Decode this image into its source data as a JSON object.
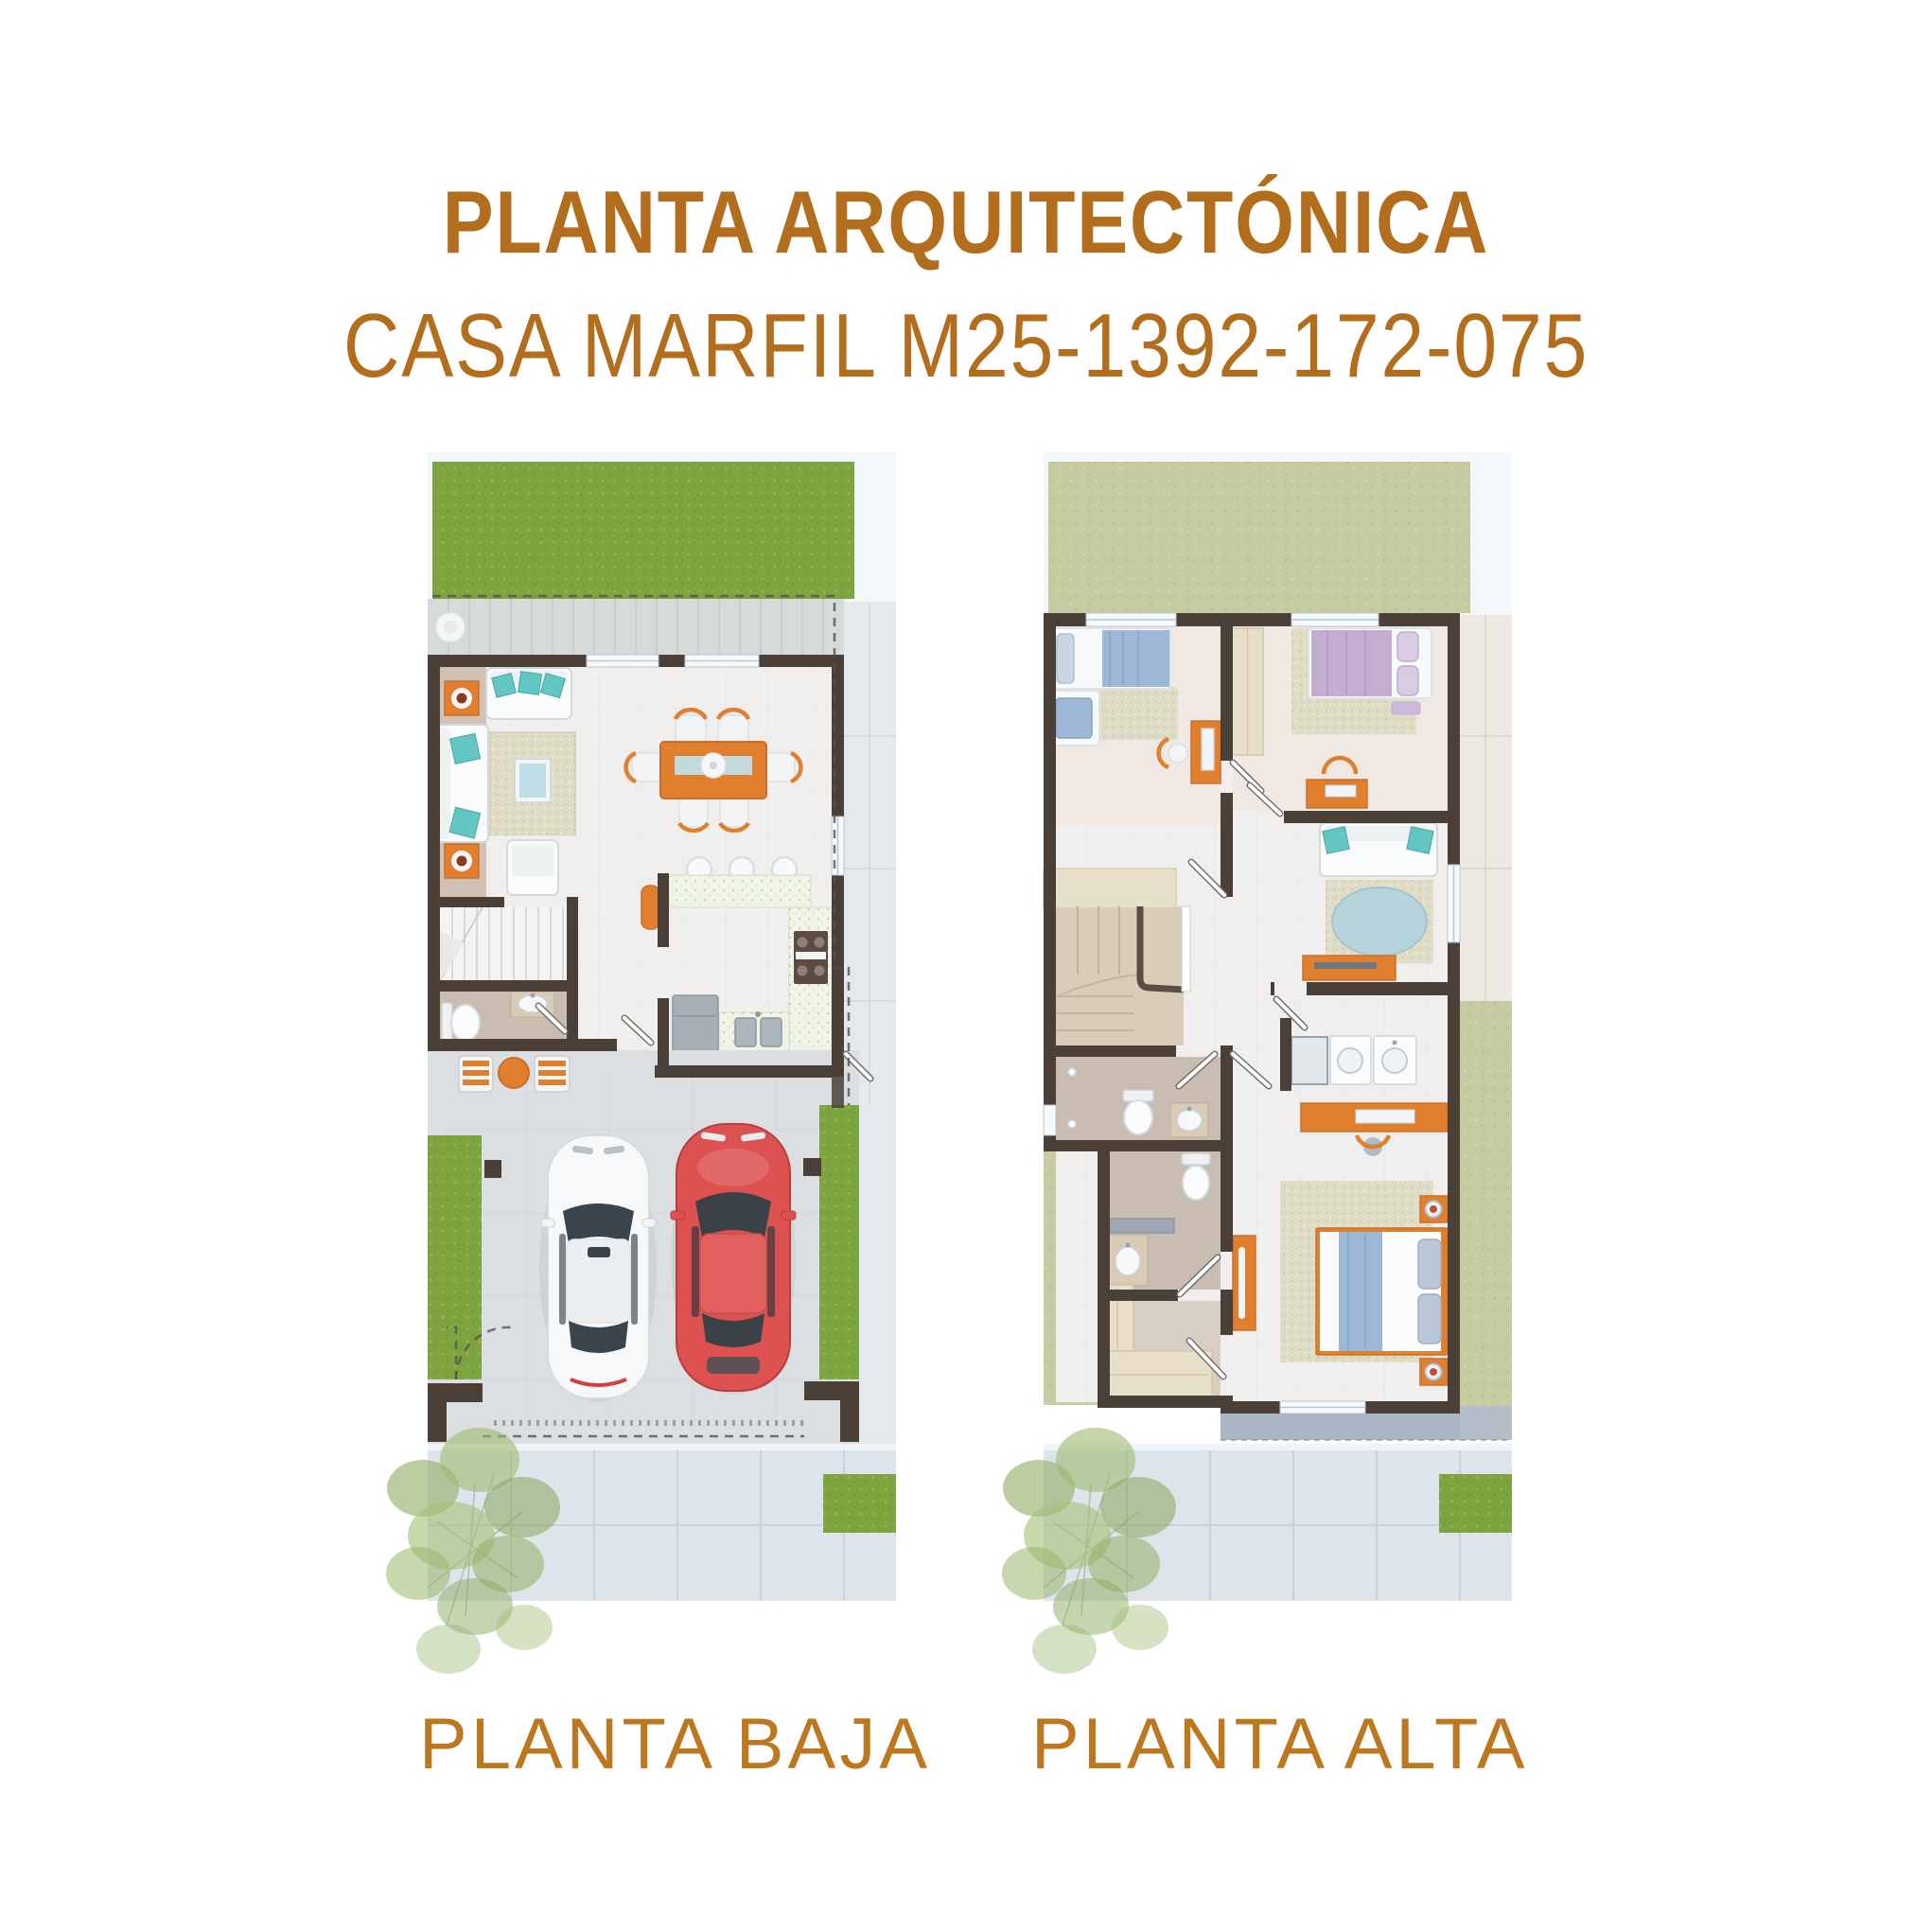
{
  "header": {
    "title": "PLANTA ARQUITECTÓNICA",
    "subtitle": "CASA MARFIL M25-1392-172-075"
  },
  "plans": [
    {
      "id": "planta-baja",
      "label": "PLANTA BAJA"
    },
    {
      "id": "planta-alta",
      "label": "PLANTA ALTA"
    }
  ],
  "colors": {
    "heading": "#b26d1d",
    "label": "#bd771f",
    "grass": "#7ea440",
    "grass_pale": "#c6cba2",
    "wall": "#4a4038",
    "floor": "#f0efee",
    "bath_floor": "#c9bcb0",
    "terrace": "#d6dadb",
    "pavement": "#dee5ea",
    "driveway": "#dbdfe2",
    "accent": "#e0802f",
    "teal": "#63c6c3",
    "rug": "#dfdcc6",
    "glass": "#bfdde6",
    "appliance_gray": "#a8b0b7",
    "wood_light": "#e8dfc8",
    "balcony": "#a9b5c3",
    "car_red": "#dd5150",
    "car_white": "#f7f8f9",
    "bed_blue": "#9db7d6",
    "bed_purple": "#c3aed2"
  }
}
